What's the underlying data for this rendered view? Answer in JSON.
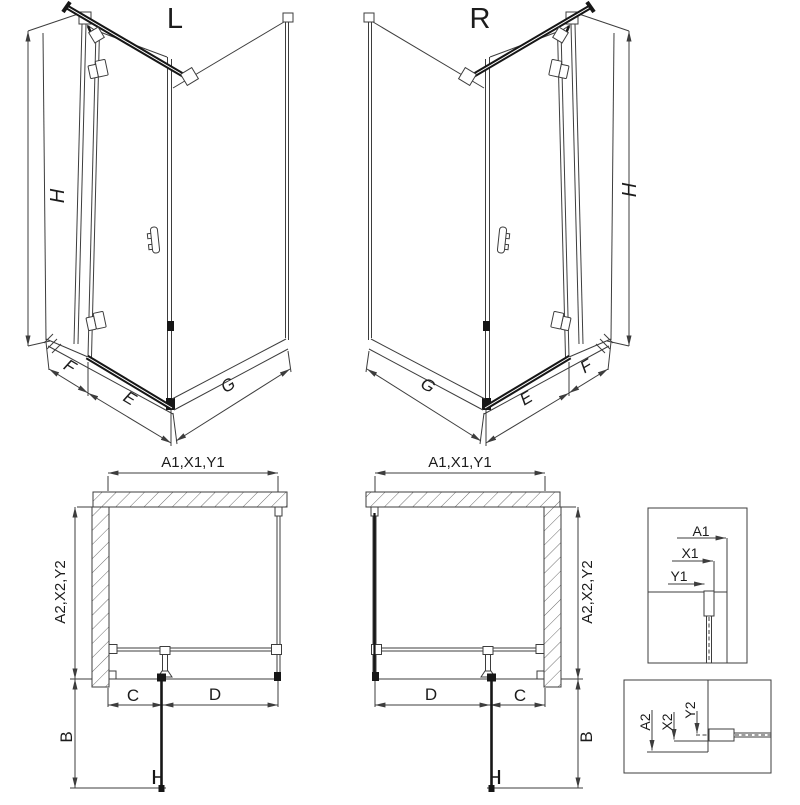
{
  "iso_left": {
    "label": "L",
    "height_dim": "H",
    "wall_dim": "F",
    "door_dim": "E",
    "side_dim": "G"
  },
  "iso_right": {
    "label": "R",
    "height_dim": "H",
    "wall_dim": "F",
    "door_dim": "E",
    "side_dim": "G"
  },
  "plan_left": {
    "width_dim": "A1,X1,Y1",
    "depth_dim": "A2,X2,Y2",
    "fixed_dim": "C",
    "door_dim": "D",
    "extent_dim": "B"
  },
  "plan_right": {
    "width_dim": "A1,X1,Y1",
    "depth_dim": "A2,X2,Y2",
    "fixed_dim": "C",
    "door_dim": "D",
    "extent_dim": "B"
  },
  "detail_top": {
    "dim_a": "A1",
    "dim_x": "X1",
    "dim_y": "Y1"
  },
  "detail_bottom": {
    "dim_a": "A2",
    "dim_x": "X2",
    "dim_y": "Y2"
  },
  "colors": {
    "line": "#3d3d3d",
    "dark": "#161616",
    "background": "#ffffff"
  }
}
